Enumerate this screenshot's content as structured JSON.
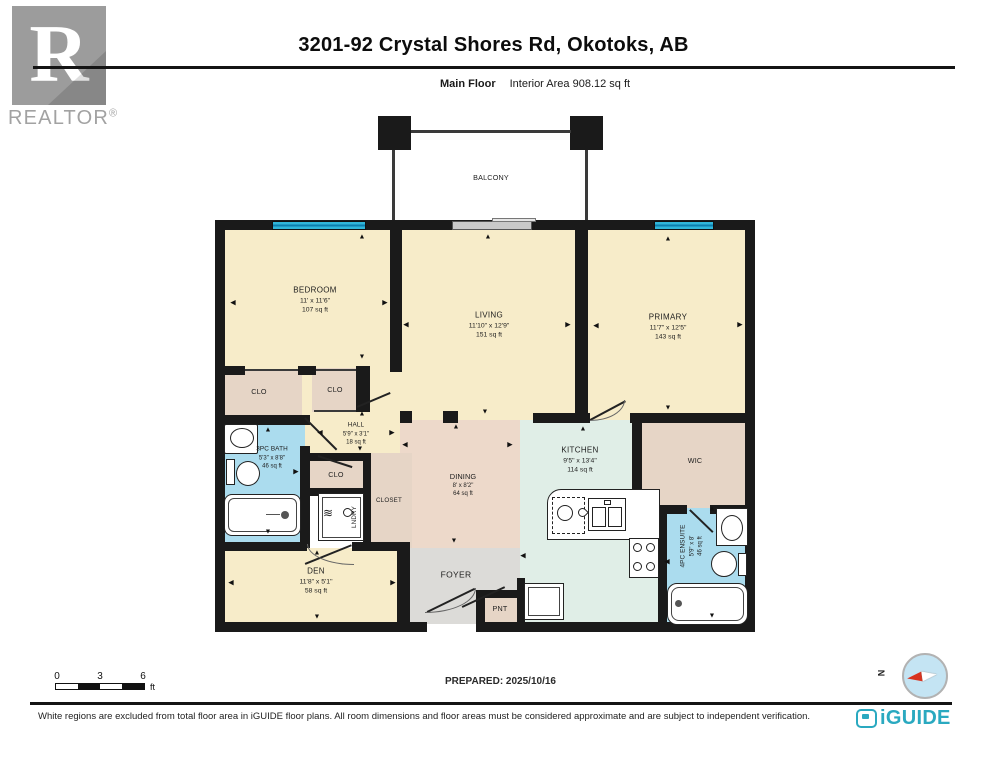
{
  "header": {
    "realtor_wordmark": "REALTOR",
    "registered": "®",
    "title": "3201-92 Crystal Shores Rd, Okotoks, AB",
    "floor_label": "Main Floor",
    "area_label": "Interior Area 908.12 sq ft"
  },
  "plan": {
    "balcony": {
      "label": "BALCONY"
    },
    "rooms": {
      "bedroom": {
        "name": "BEDROOM",
        "dims": "11' x 11'6\"",
        "area": "107 sq ft"
      },
      "living": {
        "name": "LIVING",
        "dims": "11'10\" x 12'9\"",
        "area": "151 sq ft"
      },
      "primary": {
        "name": "PRIMARY",
        "dims": "11'7\" x 12'5\"",
        "area": "143 sq ft"
      },
      "hall": {
        "name": "HALL",
        "dims": "5'9\" x 3'1\"",
        "area": "18 sq ft"
      },
      "bath3pc": {
        "name": "3PC BATH",
        "dims": "5'3\" x 8'8\"",
        "area": "46 sq ft"
      },
      "dining": {
        "name": "DINING",
        "dims": "8' x 8'2\"",
        "area": "64 sq ft"
      },
      "kitchen": {
        "name": "KITCHEN",
        "dims": "9'5\" x 13'4\"",
        "area": "114 sq ft"
      },
      "wic": {
        "name": "WIC"
      },
      "ensuite": {
        "name": "4PC ENSUITE",
        "dims": "5'9\" x 8'",
        "area": "46 sq ft"
      },
      "den": {
        "name": "DEN",
        "dims": "11'8\" x 5'1\"",
        "area": "58 sq ft"
      },
      "foyer": {
        "name": "FOYER"
      },
      "pnt": {
        "name": "PNT"
      },
      "clo1": {
        "name": "CLO"
      },
      "clo2": {
        "name": "CLO"
      },
      "clo3": {
        "name": "CLO"
      },
      "closet": {
        "name": "CLOSET"
      },
      "laundry": {
        "name": "LNDRY"
      }
    }
  },
  "icons": {
    "up": "▲",
    "down": "▼",
    "left": "◀",
    "right": "▶",
    "waves": "≋"
  },
  "footer": {
    "scale": {
      "t0": "0",
      "t3": "3",
      "t6": "6",
      "unit": "ft"
    },
    "prepared": "PREPARED: 2025/10/16",
    "compass_n": "N",
    "disclaimer": "White regions are excluded from total floor area in iGUIDE floor plans. All room dimensions and floor areas must be considered approximate and are subject to independent verification.",
    "brand": "iGUIDE"
  },
  "colors": {
    "wall": "#1a1a1a",
    "cream": "#f7ecc9",
    "tan": "#e6d5c6",
    "dining_pink": "#edd9ca",
    "bath_blue": "#abdcee",
    "kitchen_mint": "#e0eee7",
    "foyer_gray": "#dcdbd8",
    "window_cyan": "#30b6d9",
    "brand_teal": "#2aa9c0",
    "logo_gray": "#9c9c9c"
  }
}
